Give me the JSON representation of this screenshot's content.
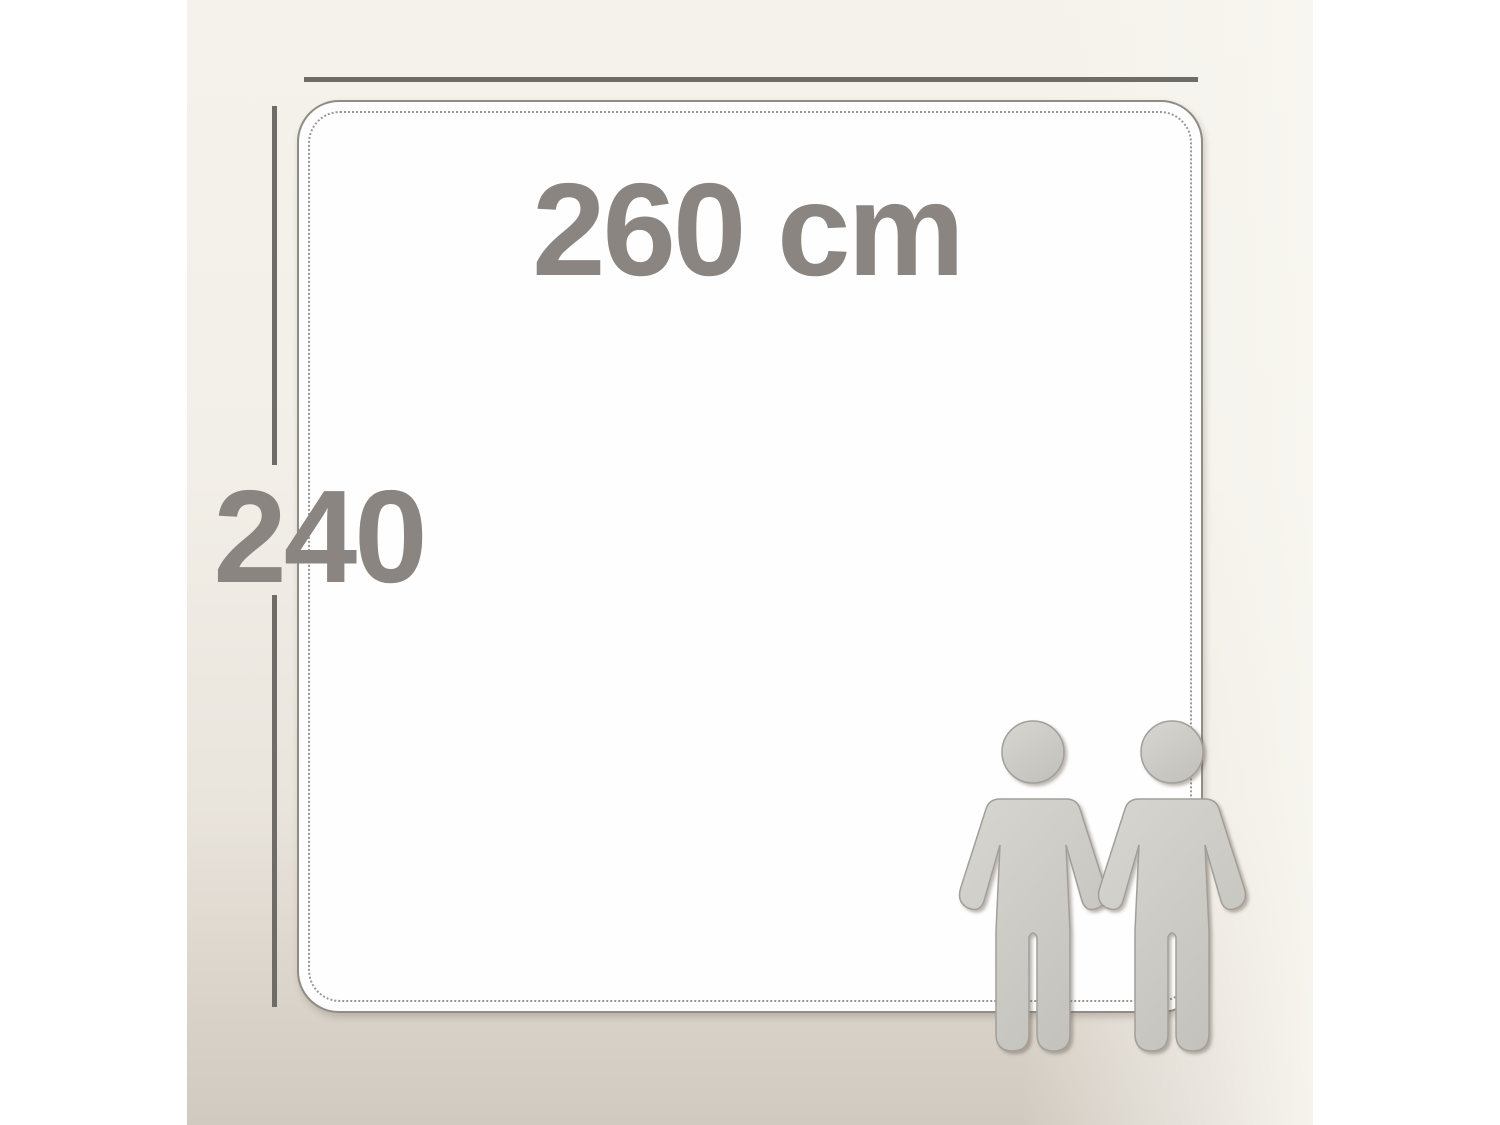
{
  "diagram": {
    "type": "product-dimension-diagram",
    "width_label": "260 cm",
    "height_label": "240",
    "scale_reference": "two standing person pictograms",
    "colors": {
      "margin": "#ffffff",
      "background_top": "#f5f2eb",
      "background_bottom": "#d1cac1",
      "panel_fill": "#fefefe",
      "panel_border": "#8f8c86",
      "panel_inner_dotted": "#9b9791",
      "dimension_line": "#6f6c68",
      "label_text": "#8a8580",
      "figure_fill_light": "#d6d4ce",
      "figure_fill_dark": "#c4c2bc",
      "figure_outline": "#a29f99"
    }
  }
}
